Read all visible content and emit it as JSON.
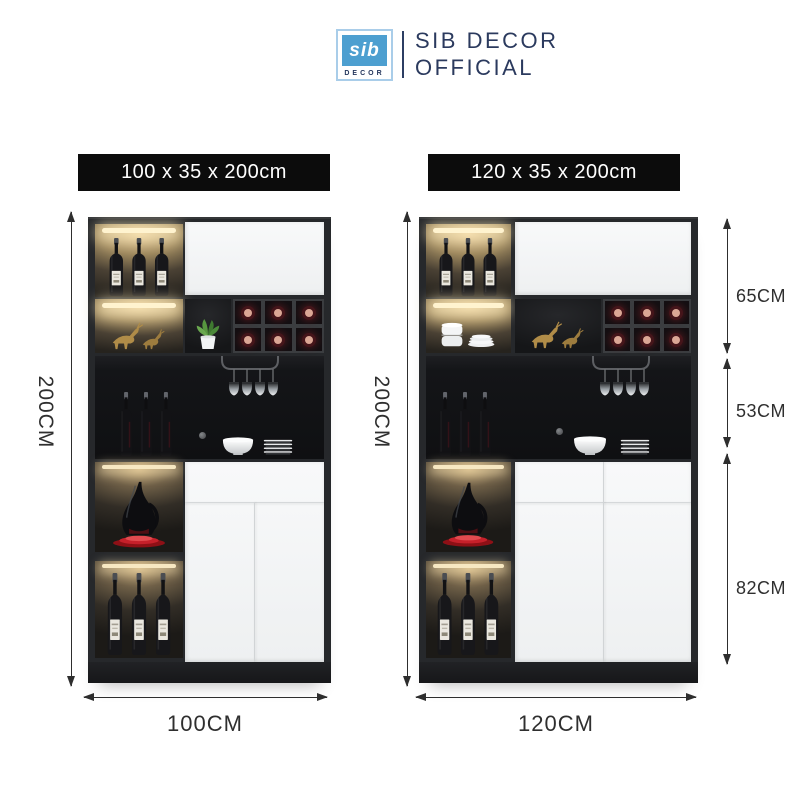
{
  "header": {
    "logo": {
      "monogram": "sib",
      "wordmark": "DECOR"
    },
    "brand_line1": "SIB DECOR",
    "brand_line2": "OFFICIAL"
  },
  "products": [
    {
      "banner": "100 x 35 x 200cm",
      "height": "200CM",
      "width": "100CM"
    },
    {
      "banner": "120 x 35 x 200cm",
      "height": "200CM",
      "width": "120CM",
      "sections": [
        "65CM",
        "53CM",
        "82CM"
      ]
    }
  ],
  "colors": {
    "banner_bg": "#0c0c0c",
    "banner_text": "#ffffff",
    "brand_navy": "#2b3a5e",
    "logo_blue": "#4d9fd0",
    "logo_border": "#a9cde9",
    "dimension_text": "#2f2f2f",
    "cabinet_frame": "#26282b",
    "door_white": "#f5f6f7",
    "warm_light": "#e8cf9e",
    "wine_cap_pink": "#dba795",
    "gold_decor": "#b08c48",
    "red_plate": "#c6202a",
    "plant_green": "#57963f"
  }
}
